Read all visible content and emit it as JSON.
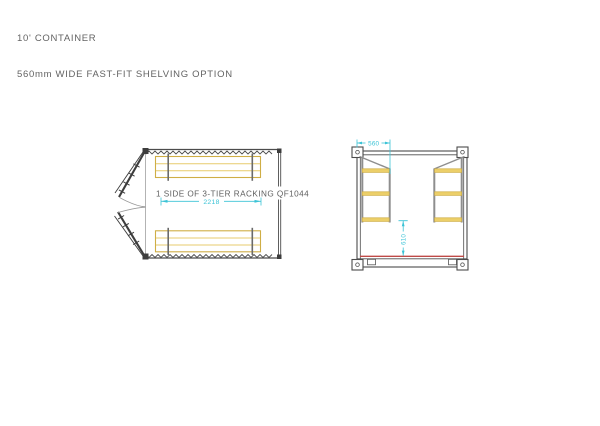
{
  "title": {
    "line1": "10' CONTAINER",
    "line2": "560mm WIDE FAST-FIT SHELVING OPTION"
  },
  "plan_view": {
    "rack_label": "1 SIDE OF 3-TIER RACKING QF1044",
    "length_dim": "2218"
  },
  "end_view": {
    "shelf_width_dim": "560",
    "clear_height_dim": "610"
  },
  "colors": {
    "line_dark": "#4c4c4c",
    "frame_gray": "#8e8e8e",
    "shelf_yellow": "#eccf69",
    "shelf_border": "#cfae45",
    "dimension_cyan": "#3bc3d6",
    "floor_red": "#bf4a47",
    "text_gray": "#636363",
    "background": "#ffffff"
  }
}
